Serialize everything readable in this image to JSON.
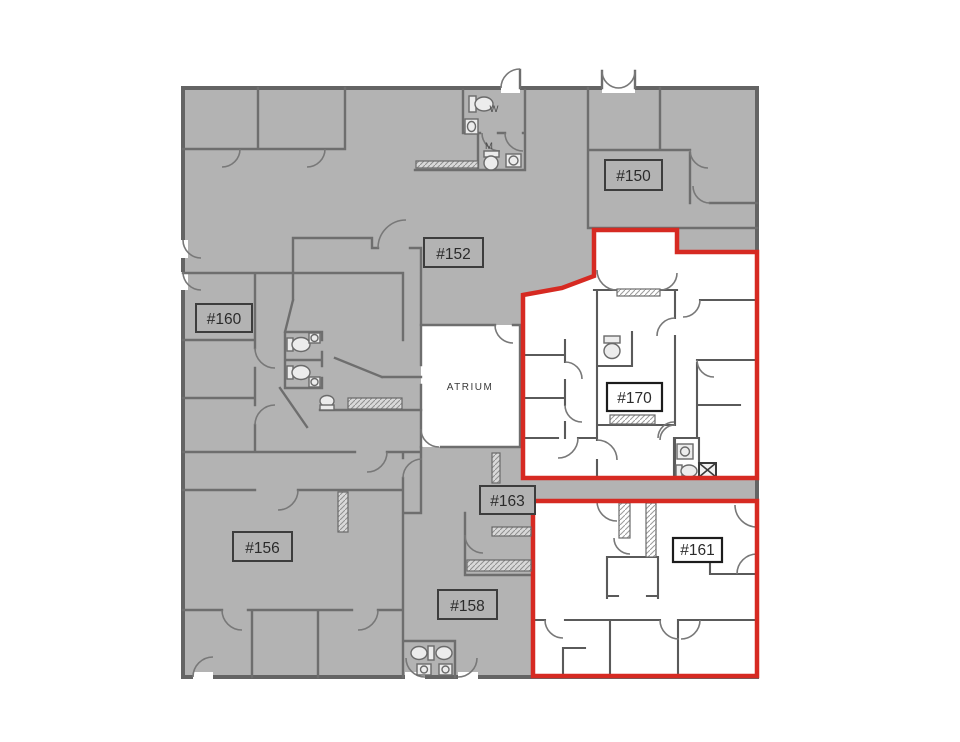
{
  "canvas": {
    "width": 960,
    "height": 742,
    "background": "#ffffff"
  },
  "colors": {
    "floor_fill": "#b3b3b3",
    "wall": "#6e6e6e",
    "highlight_outline": "#d62a22",
    "label_border": "#3d3d3d",
    "text": "#2b2b2b",
    "white_area": "#ffffff"
  },
  "plan": {
    "type": "office-building-floor-plan",
    "atrium_label": "ATRIUM",
    "restrooms": {
      "women_label": "W",
      "men_label": "M"
    },
    "suites": [
      {
        "id": "150",
        "label": "#150",
        "highlighted": false
      },
      {
        "id": "152",
        "label": "#152",
        "highlighted": false
      },
      {
        "id": "156",
        "label": "#156",
        "highlighted": false
      },
      {
        "id": "158",
        "label": "#158",
        "highlighted": false
      },
      {
        "id": "160",
        "label": "#160",
        "highlighted": false
      },
      {
        "id": "161",
        "label": "#161",
        "highlighted": true
      },
      {
        "id": "163",
        "label": "#163",
        "highlighted": false
      },
      {
        "id": "170",
        "label": "#170",
        "highlighted": true
      }
    ],
    "highlighted_suites": [
      "#170",
      "#161"
    ]
  }
}
